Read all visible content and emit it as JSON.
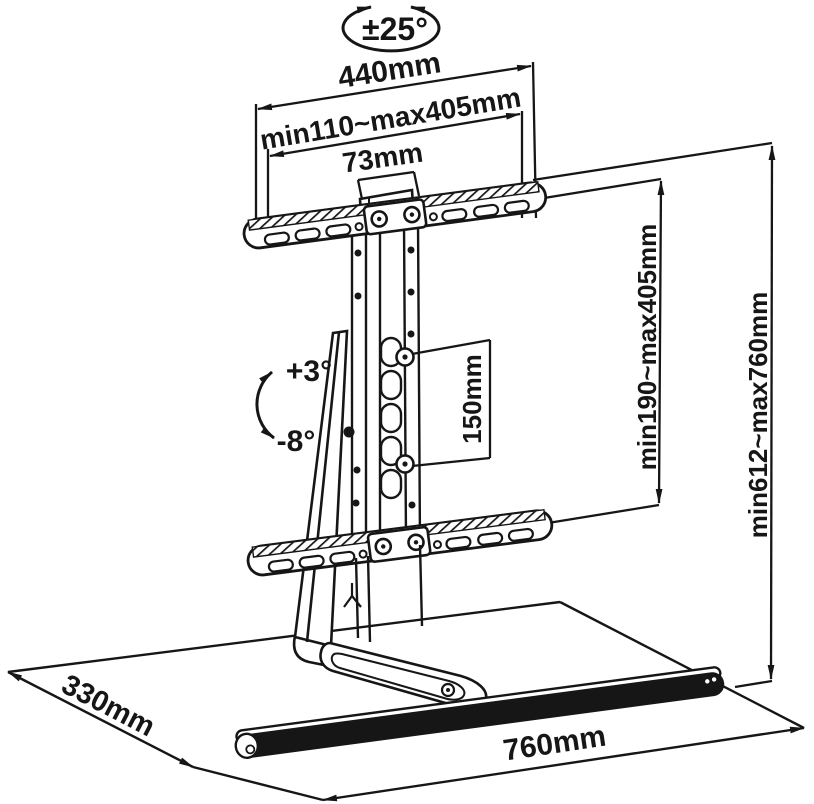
{
  "diagram": {
    "title": "TV stand mount technical drawing",
    "labels": {
      "swivel_angle": "±25°",
      "total_width": "440mm",
      "width_range": "min110~max405mm",
      "column_width": "73mm",
      "tilt_up": "+3°",
      "tilt_down": "-8°",
      "slot_travel": "150mm",
      "vesa_height_range": "min190~max405mm",
      "total_height_range": "min612~max760mm",
      "base_depth": "330mm",
      "base_width": "760mm"
    },
    "colors": {
      "line": "#161616",
      "background": "#ffffff"
    }
  }
}
